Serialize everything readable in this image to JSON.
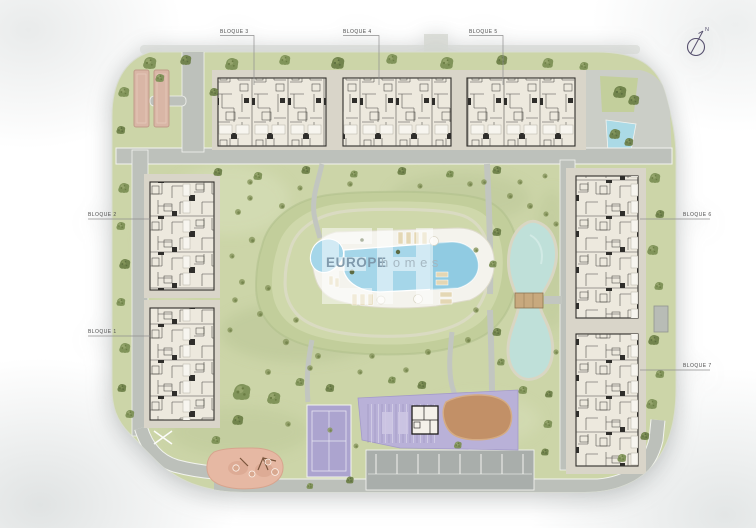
{
  "plan": {
    "blocks": [
      {
        "id": "bloque-1",
        "label": "BLOQUE 1"
      },
      {
        "id": "bloque-2",
        "label": "BLOQUE 2"
      },
      {
        "id": "bloque-3",
        "label": "BLOQUE 3"
      },
      {
        "id": "bloque-4",
        "label": "BLOQUE 4"
      },
      {
        "id": "bloque-5",
        "label": "BLOQUE 5"
      },
      {
        "id": "bloque-6",
        "label": "BLOQUE 6"
      },
      {
        "id": "bloque-7",
        "label": "BLOQUE 7"
      }
    ],
    "compass": {
      "north_label": "N"
    },
    "watermark": {
      "monogram": "EH",
      "brand_primary": "EUROPE",
      "brand_secondary": "homes"
    },
    "colors": {
      "grass": "#ccd5a8",
      "mound": "#c2ce9b",
      "plateau": "#cfd8ab",
      "path_gray": "#bdc1bb",
      "plaza_gray": "#cbcec7",
      "parking_gray": "#a9aeab",
      "pool_blue": "#a5d6e9",
      "pond_teal": "#bfe0d9",
      "court_purple": "#aca4cf",
      "zone_purple": "#b9b1d8",
      "playground_pink": "#e6b8a3",
      "sand_brown": "#c29067",
      "court_tan": "#d9b6a6",
      "building_fill": "#ede9de",
      "building_pad": "#d9d5c9",
      "bridge_tan": "#c8a97e",
      "label_text": "#4d4d4d"
    }
  }
}
